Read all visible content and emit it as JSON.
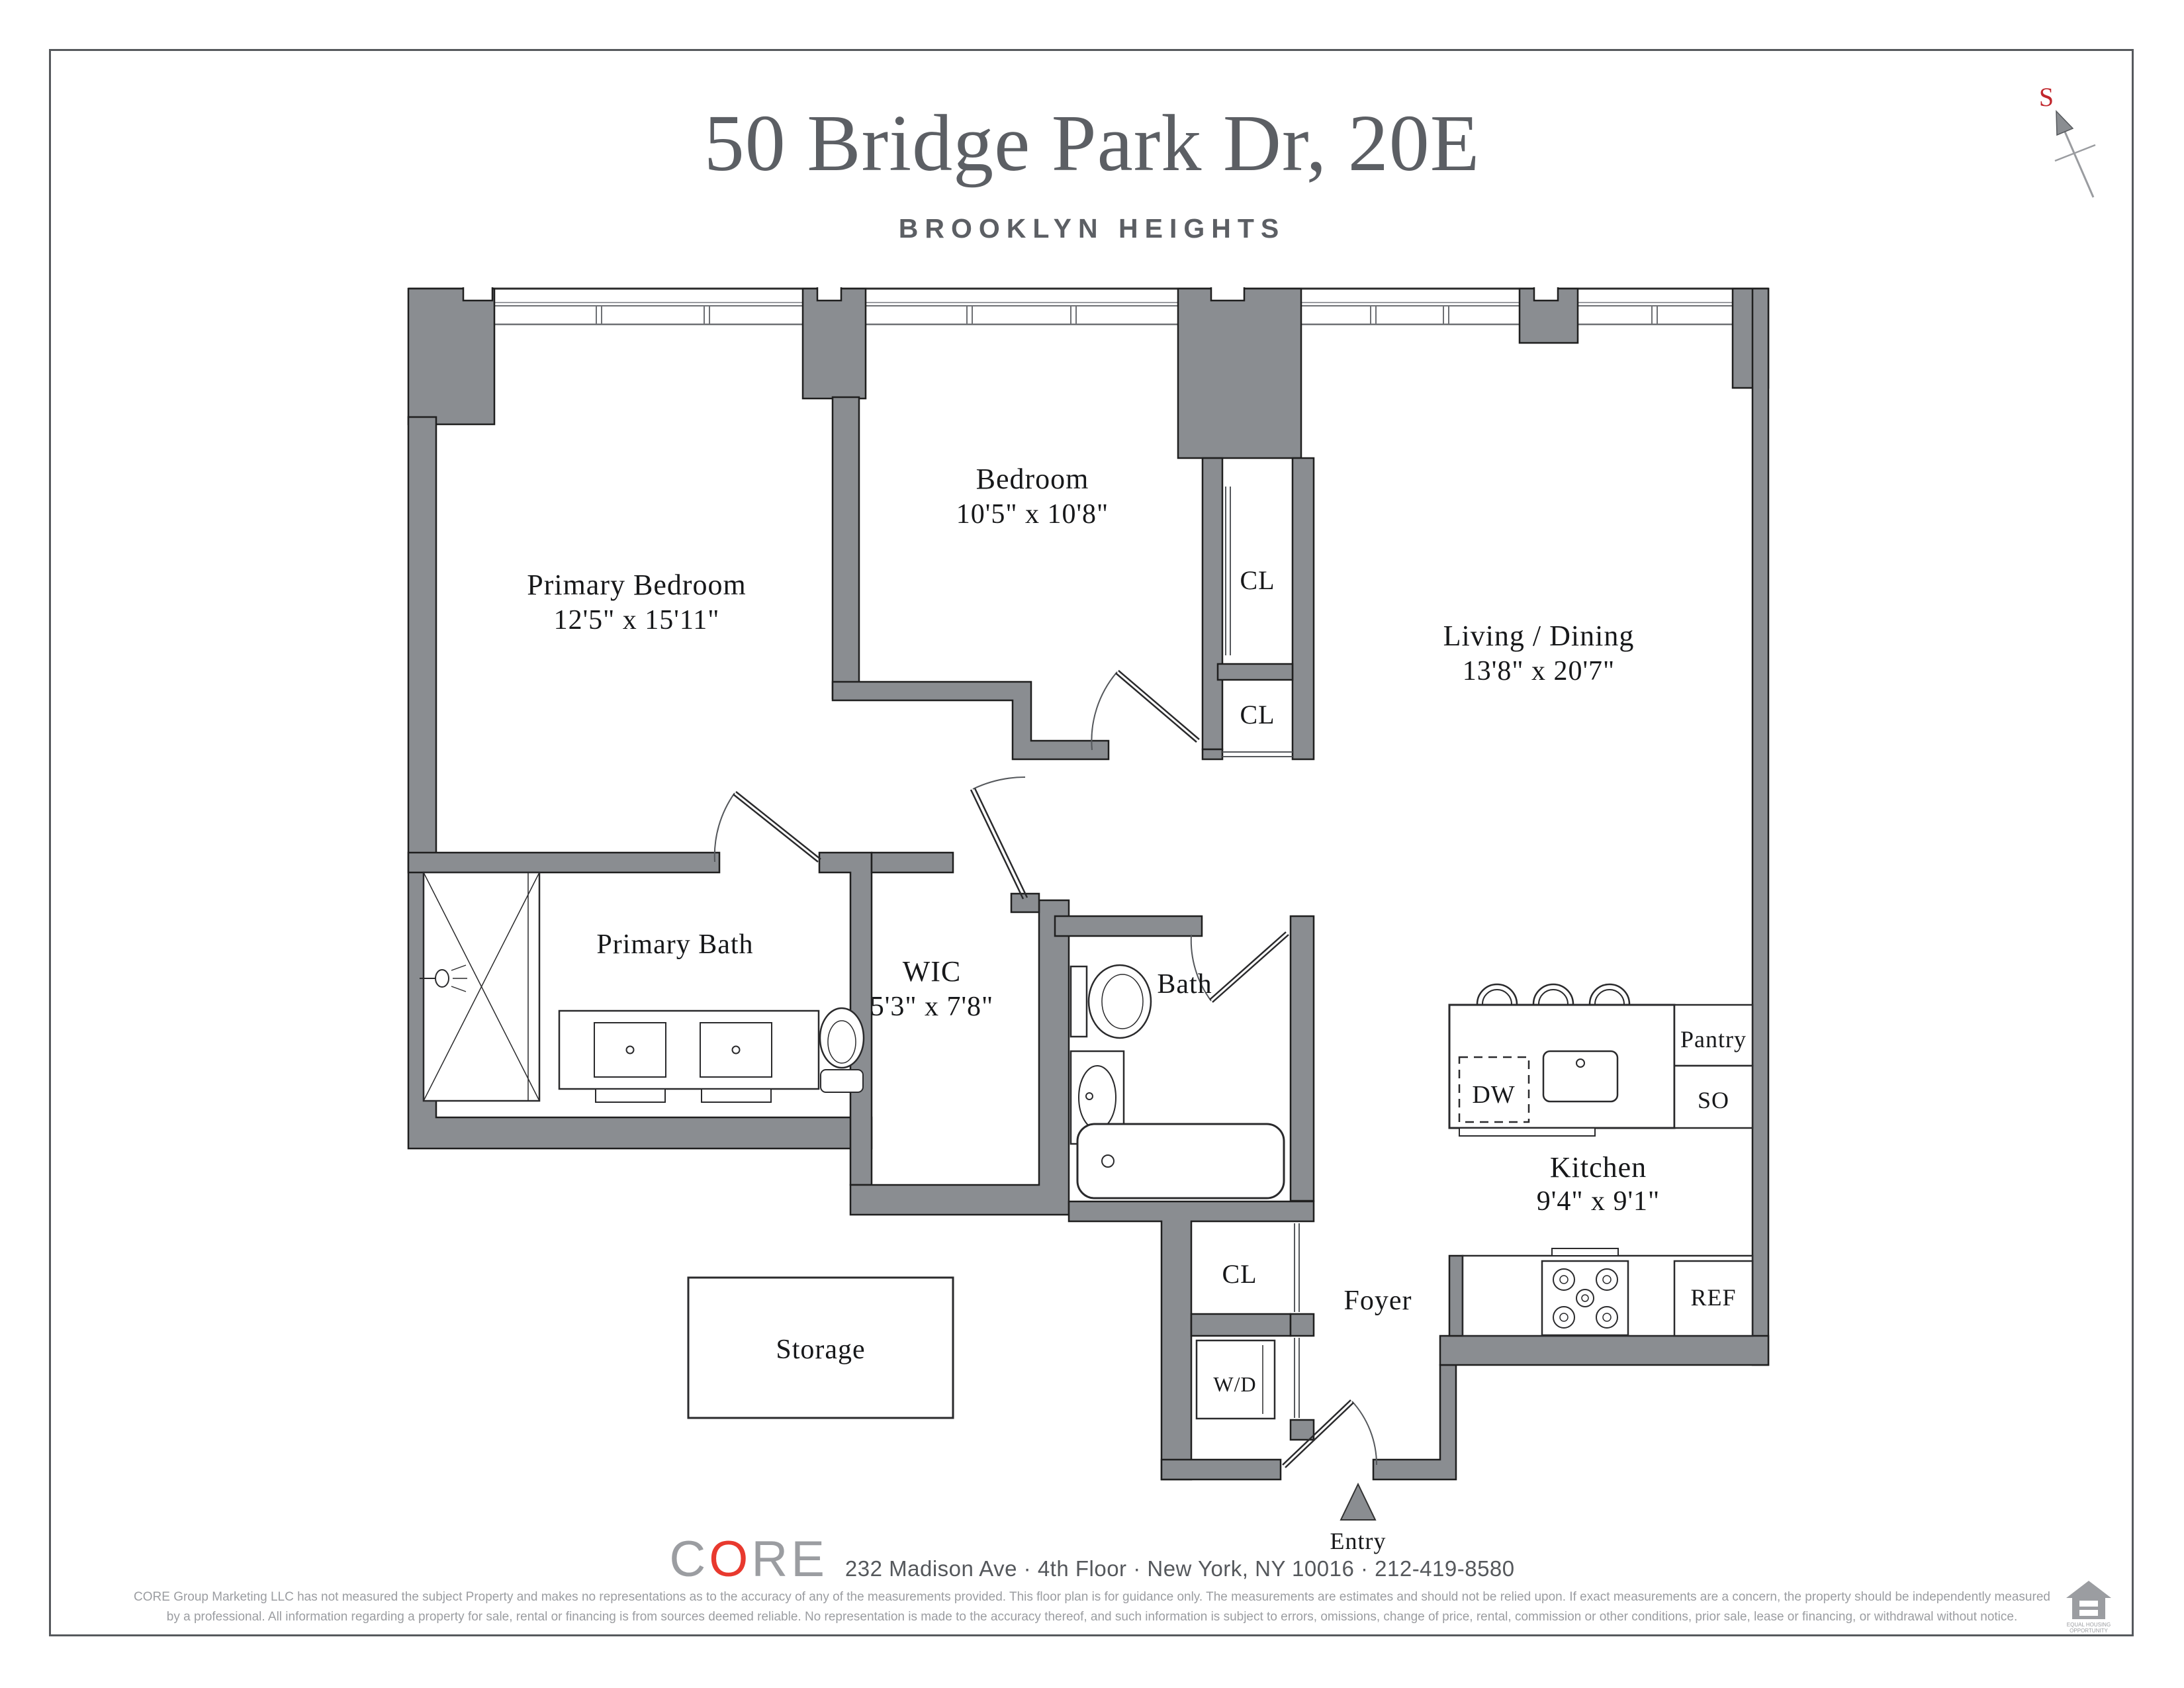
{
  "page": {
    "title": "50 Bridge Park Dr, 20E",
    "subtitle": "BROOKLYN HEIGHTS",
    "compass_label": "S"
  },
  "rooms": {
    "primary_bedroom": {
      "name": "Primary Bedroom",
      "dims": "12'5\" x 15'11\""
    },
    "bedroom": {
      "name": "Bedroom",
      "dims": "10'5\" x 10'8\""
    },
    "living_dining": {
      "name": "Living / Dining",
      "dims": "13'8\" x 20'7\""
    },
    "primary_bath": {
      "name": "Primary Bath"
    },
    "wic": {
      "name": "WIC",
      "dims": "5'3\" x 7'8\""
    },
    "bath": {
      "name": "Bath"
    },
    "kitchen": {
      "name": "Kitchen",
      "dims": "9'4\" x 9'1\""
    },
    "foyer": {
      "name": "Foyer"
    },
    "storage": {
      "name": "Storage"
    },
    "entry": {
      "name": "Entry"
    }
  },
  "closets": {
    "cl_bedroom": "CL",
    "cl_hall": "CL",
    "cl_foyer": "CL"
  },
  "appliances": {
    "dw": "DW",
    "pantry": "Pantry",
    "so": "SO",
    "ref": "REF",
    "wd": "W/D"
  },
  "footer": {
    "brand_c": "C",
    "brand_o": "O",
    "brand_re": "RE",
    "address": "232 Madison Ave · 4th Floor · New York, NY 10016 · 212-419-8580",
    "disclaimer_line1": "CORE Group Marketing LLC has not measured the subject Property and makes no representations as to the accuracy of any of the measurements provided. This floor plan is for guidance only. The measurements are estimates and should not be relied upon. If exact measurements are a concern, the property should be independently measured",
    "disclaimer_line2": "by a professional. All information regarding a property for sale, rental or financing is from sources deemed reliable.  No representation is made to the accuracy thereof, and such information is subject to errors, omissions, change of price, rental, commission or other conditions, prior sale, lease or financing, or withdrawal without notice.",
    "eho_line1": "EQUAL HOUSING",
    "eho_line2": "OPPORTUNITY"
  },
  "colors": {
    "wall": "#8a8d91",
    "outline": "#1f1f1f",
    "accent_red": "#e8392e",
    "compass_red": "#c1272d",
    "heading": "#5c5f64",
    "muted": "#9b9da1"
  }
}
